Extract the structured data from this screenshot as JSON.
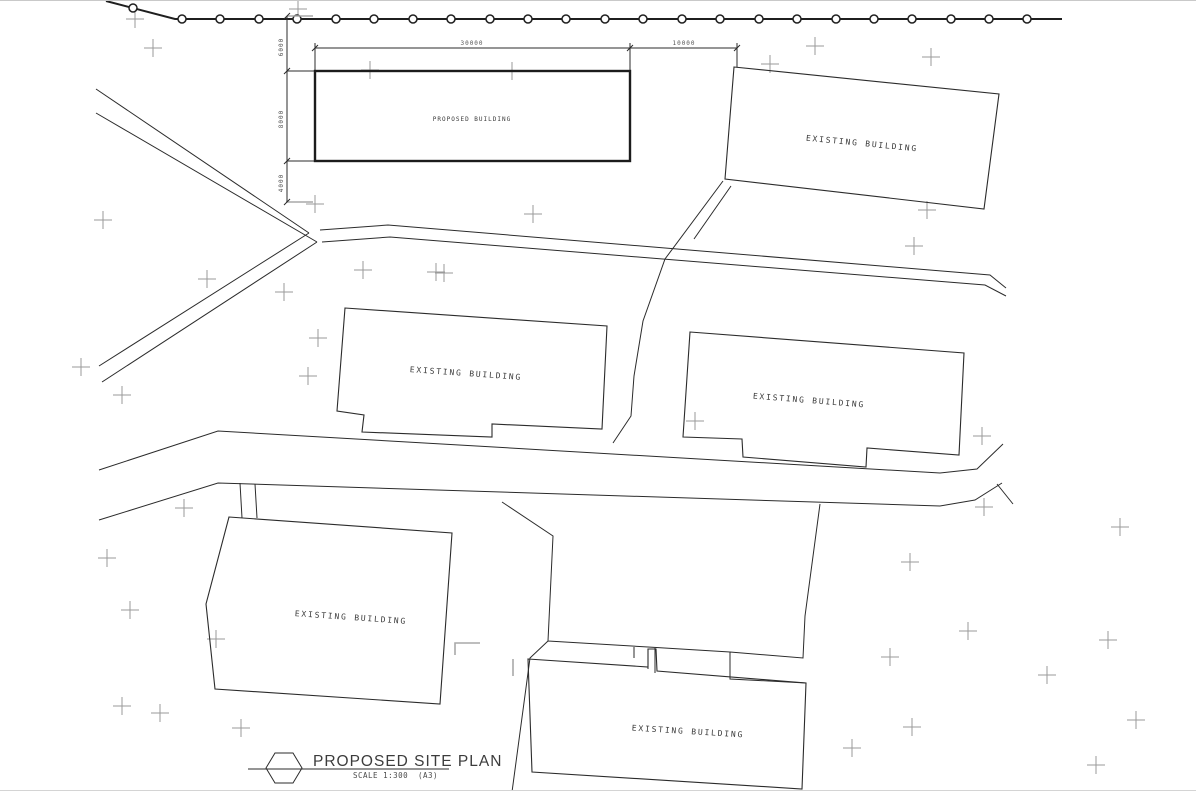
{
  "drawing": {
    "title": "PROPOSED SITE PLAN",
    "scale": "SCALE  1:300",
    "sheet": "(A3)"
  },
  "buildings": [
    {
      "name": "proposed-building",
      "label": "PROPOSED BUILDING"
    },
    {
      "name": "existing-building-north-east",
      "label": "EXISTING BUILDING"
    },
    {
      "name": "existing-building-centre-west",
      "label": "EXISTING BUILDING"
    },
    {
      "name": "existing-building-centre-east",
      "label": "EXISTING BUILDING"
    },
    {
      "name": "existing-building-south-west",
      "label": "EXISTING BUILDING"
    },
    {
      "name": "existing-building-south-centre",
      "label": "EXISTING BUILDING"
    }
  ],
  "dimensions": {
    "building_width": "30000",
    "side_offset": "10000",
    "front_setback": "6000",
    "building_depth": "8000",
    "rear_margin": "4000"
  },
  "colors": {
    "line": "#2b2b2b",
    "survey_marker": "#9a9a9a",
    "text": "#3a3a3a"
  }
}
